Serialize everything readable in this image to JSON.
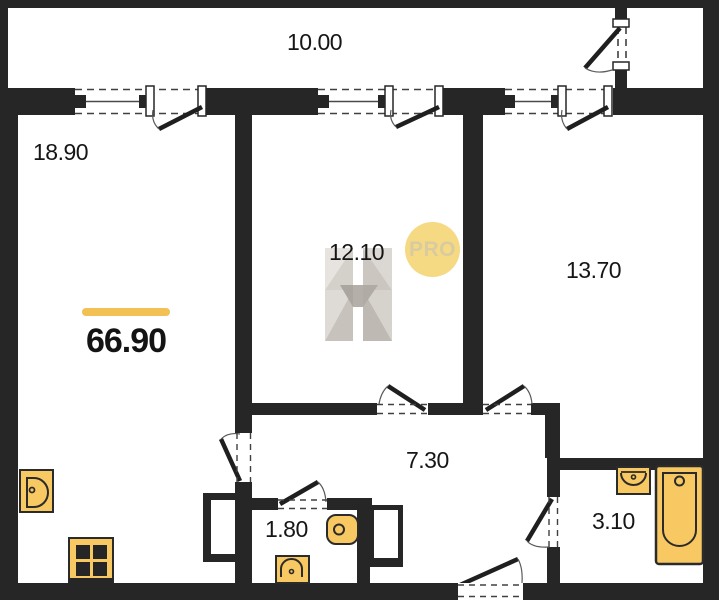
{
  "plan": {
    "title": "apartment-floor-plan",
    "total_area": {
      "value": "66.90"
    },
    "rooms": [
      {
        "id": "balcony",
        "area": "10.00"
      },
      {
        "id": "kitchen-living",
        "area": "18.90"
      },
      {
        "id": "bedroom",
        "area": "12.10"
      },
      {
        "id": "bedroom-2",
        "area": "13.70"
      },
      {
        "id": "hallway",
        "area": "7.30"
      },
      {
        "id": "wc",
        "area": "1.80"
      },
      {
        "id": "bathroom",
        "area": "3.10"
      }
    ],
    "badge": {
      "label": "PRO"
    },
    "watermark": {
      "letter": "H"
    },
    "fixtures": [
      "kitchen-sink",
      "stove",
      "toilet",
      "wc-sink",
      "bath-sink",
      "bathtub"
    ],
    "colors": {
      "wall": "#262626",
      "fixture_fill": "#F8C862",
      "accent_bar": "#F2C053",
      "badge_bg": "#F6D983",
      "badge_text": "#D9CBA0",
      "background": "#FFFFFF"
    }
  }
}
